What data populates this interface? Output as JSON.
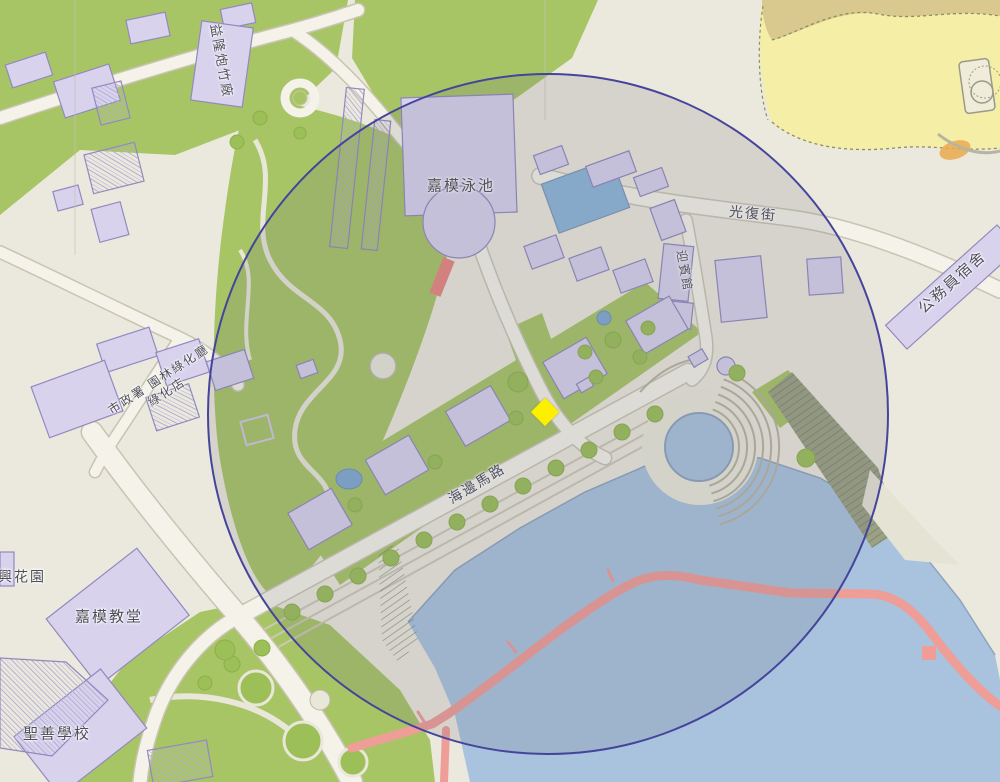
{
  "map": {
    "labels": [
      {
        "id": "yik-long-firecracker-factory",
        "text": "益隆炮竹廠",
        "x": 221,
        "y": 61,
        "rotation": 80,
        "font_size": 13
      },
      {
        "id": "carmo-swimming-pool",
        "text": "嘉模泳池",
        "x": 461,
        "y": 187,
        "rotation": 0,
        "font_size": 15
      },
      {
        "id": "kuang-fu-street",
        "text": "光復街",
        "x": 753,
        "y": 214,
        "rotation": 5,
        "font_size": 14
      },
      {
        "id": "guest-house",
        "text": "迎賓館",
        "x": 684,
        "y": 271,
        "rotation": 80,
        "font_size": 12
      },
      {
        "id": "civil-servant-quarters",
        "text": "公務員宿舍",
        "x": 953,
        "y": 283,
        "rotation": -42,
        "font_size": 15
      },
      {
        "id": "iam-greening-depot",
        "lines": [
          "市政署 園林綠化廳",
          "綠化店"
        ],
        "x": 163,
        "y": 386,
        "rotation": -33,
        "font_size": 12
      },
      {
        "id": "seaside-road",
        "text": "海邊馬路",
        "x": 477,
        "y": 484,
        "rotation": -31,
        "font_size": 14
      },
      {
        "id": "hing-garden",
        "text": "興花園",
        "x": 22,
        "y": 577,
        "rotation": 0,
        "font_size": 14
      },
      {
        "id": "carmo-church",
        "text": "嘉模教堂",
        "x": 109,
        "y": 618,
        "rotation": 0,
        "font_size": 15
      },
      {
        "id": "sheng-san-school",
        "text": "聖善學校",
        "x": 57,
        "y": 735,
        "rotation": 0,
        "font_size": 15
      }
    ],
    "marker": {
      "shape": "diamond",
      "color": "#fcf000",
      "x": 545,
      "y": 412,
      "size": 20
    },
    "radius_circle": {
      "cx": 546,
      "cy": 412,
      "r": 339,
      "stroke": "#45449c",
      "stroke_width": 2,
      "fill": "rgba(104,108,126,0.17)"
    },
    "colors": {
      "land": "#ebe9dd",
      "green": "#a8c566",
      "tree": "#9cbf58",
      "water": "#a9c3de",
      "pool_blue": "#8cb6da",
      "sand": "#f4eea6",
      "sand_dark": "#d9c98f",
      "building_fill": "#d8d2ed",
      "building_stroke": "#9189bf",
      "road": "#f4f2e9",
      "road_casing": "#c8c4b2",
      "boardwalk_red": "#ee9d97",
      "wall_red": "#e9867f",
      "label_text": "#4e4e59"
    }
  }
}
